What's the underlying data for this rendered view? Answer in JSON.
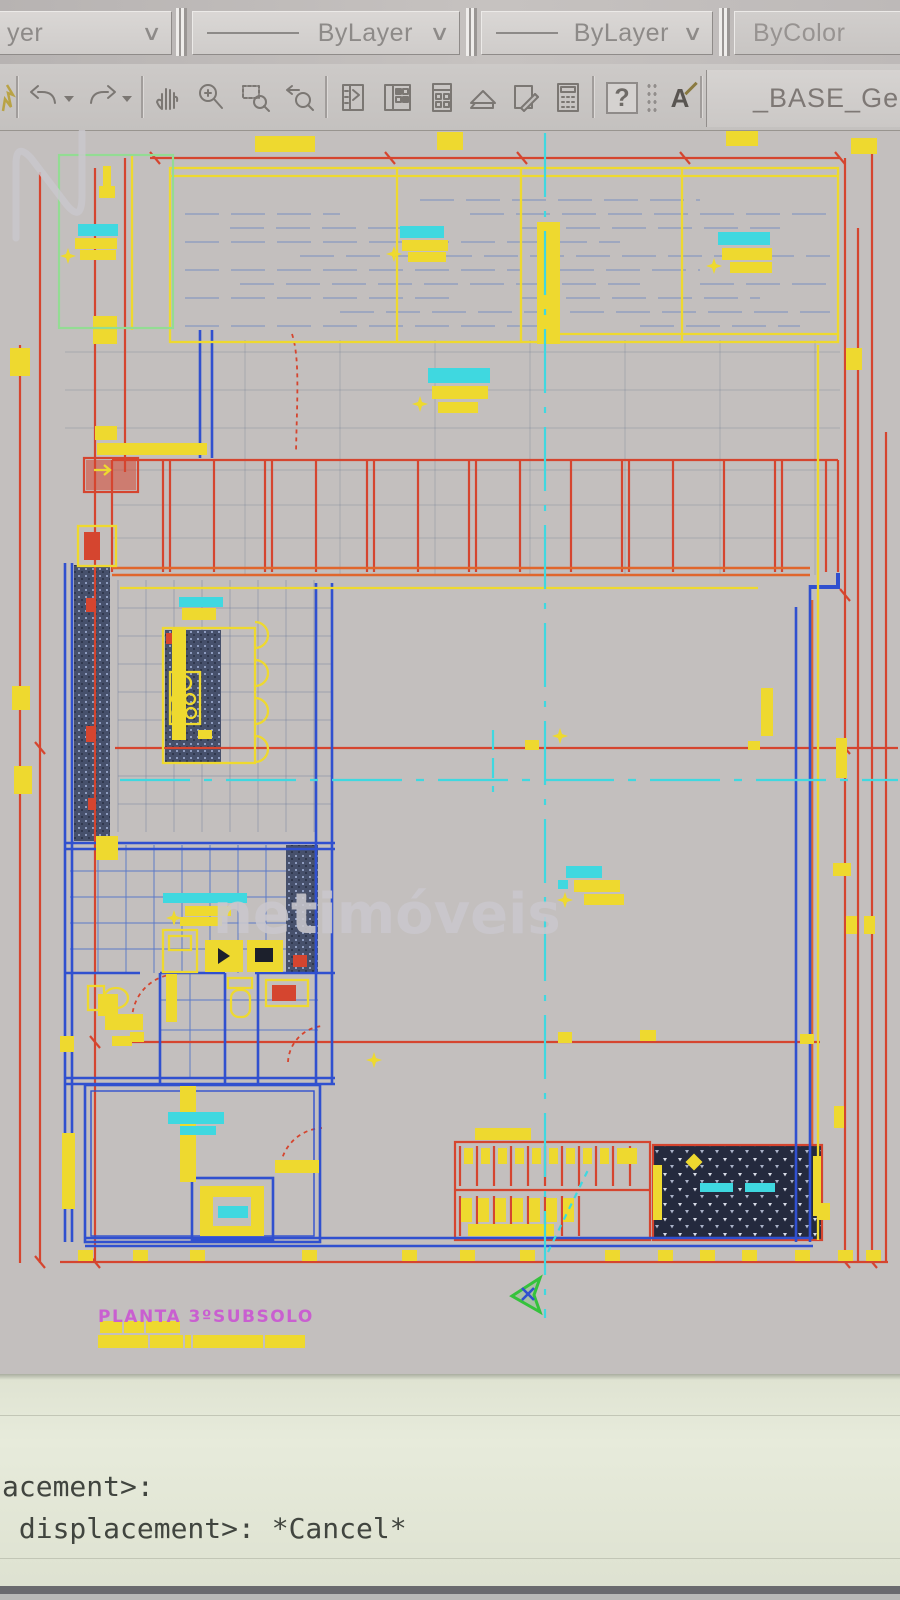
{
  "toolbar_top": {
    "dropdowns": [
      {
        "label": "yer"
      },
      {
        "label": "ByLayer"
      },
      {
        "label": "ByLayer"
      },
      {
        "label": "ByColor"
      }
    ],
    "chevron": "∨"
  },
  "toolbar_icons": {
    "icons": [
      "brush-partial",
      "undo",
      "undo-dropdown",
      "redo",
      "redo-dropdown",
      "pan-hand",
      "zoom-realtime",
      "zoom-window",
      "zoom-previous",
      "properties",
      "designcenter",
      "tool-palettes",
      "sheet-set-manager",
      "markup-set-manager",
      "quickcalc",
      "help",
      "text-style"
    ],
    "help_label": "?",
    "text_style_label": "A",
    "style_name": "_BASE_Gera"
  },
  "drawing": {
    "plan_title": "PLANTA 3ºSUBSOLO",
    "watermark_text": "netimóveis"
  },
  "command_line": {
    "lines": [
      "acement>:",
      " displacement>: *Cancel*"
    ]
  },
  "colors": {
    "cad_yellow": "#eed92f",
    "cad_red": "#d5452f",
    "cad_blue": "#3050cf",
    "cad_cyan": "#3fd8e0",
    "cad_green": "#35c23c",
    "cad_magenta": "#c95fd0",
    "toolbar_gray": "#c3bfbe",
    "command_bg": "#e7ebdb"
  }
}
